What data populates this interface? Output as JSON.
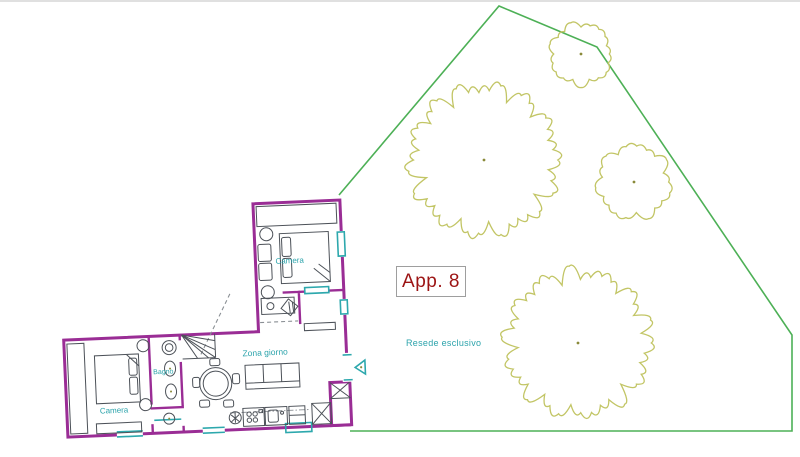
{
  "labels": {
    "apartment": "App. 8",
    "garden": "Resede esclusivo",
    "camera_upper": "Camera",
    "camera_lower": "Camera",
    "bagno": "Bagno",
    "zona_giorno": "Zona giorno"
  },
  "colors": {
    "wall": "#9a2d95",
    "furniture": "#4c5158",
    "fixture_teal": "#2da8ad",
    "room_label": "#2ba3ab",
    "apartment_text": "#9c1414",
    "apartment_border": "#9e9e9e",
    "boundary_green": "#4db056",
    "tree_olive": "#c2c565",
    "tree_dot": "#8a8a3a",
    "dash_gray": "#8a8f94"
  },
  "garden": {
    "boundary_points": "339,193 499,4 597,45 792,333 792,429 350,429",
    "trees": [
      {
        "cx": 484,
        "cy": 158,
        "r": 76,
        "seed": 3
      },
      {
        "cx": 581,
        "cy": 52,
        "r": 32,
        "seed": 7
      },
      {
        "cx": 634,
        "cy": 180,
        "r": 38,
        "seed": 5
      },
      {
        "cx": 578,
        "cy": 341,
        "r": 74,
        "seed": 9
      }
    ]
  }
}
